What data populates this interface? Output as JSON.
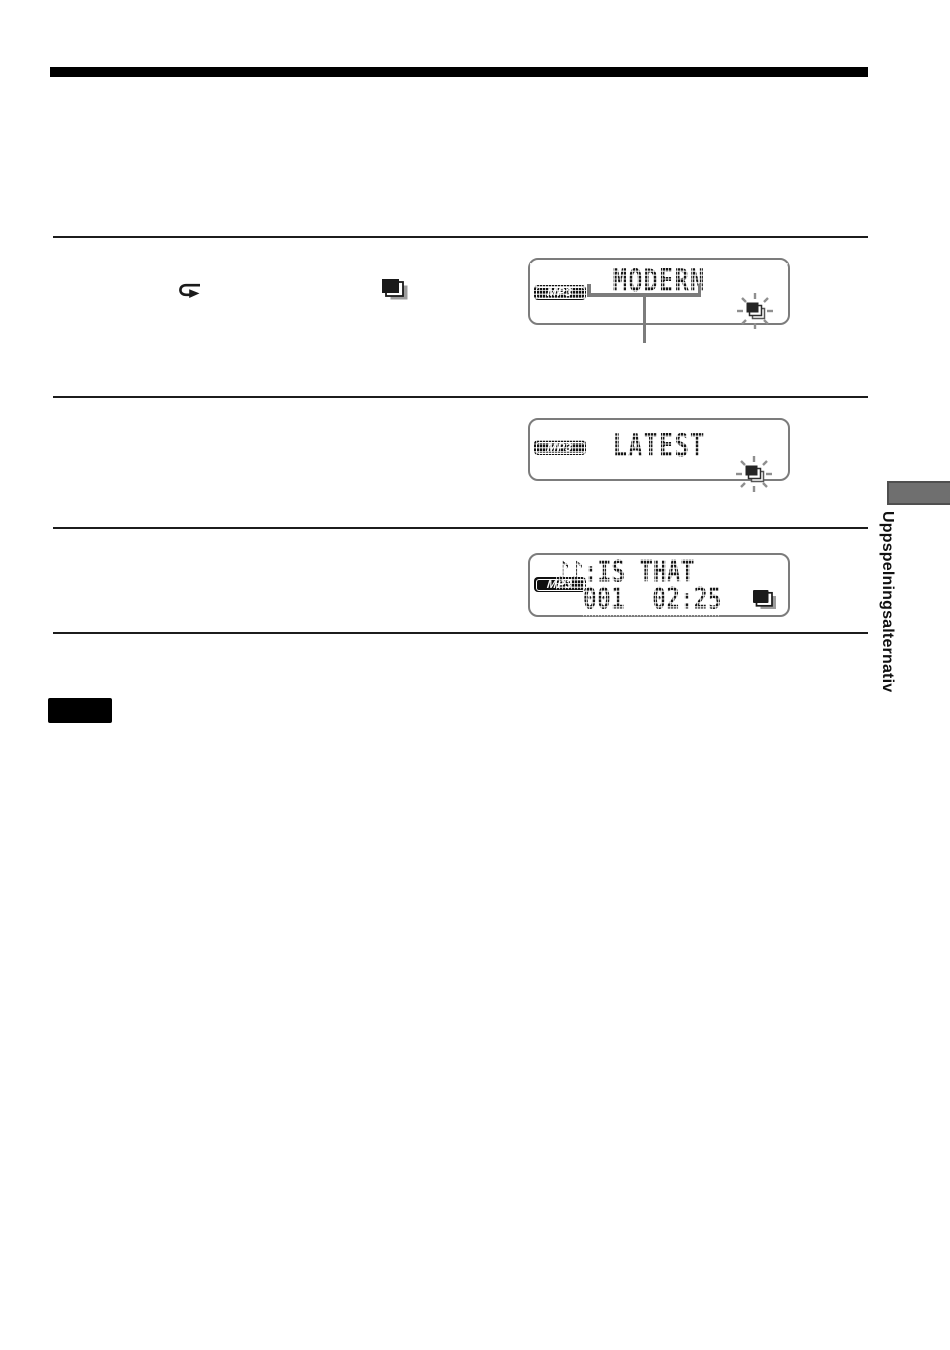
{
  "sidebar": {
    "label": "Uppspelningsalternativ"
  },
  "displays": [
    {
      "badge": "MP3",
      "line1": "MODERN"
    },
    {
      "badge": "MP3",
      "line1": "LATEST"
    },
    {
      "badge": "MP3",
      "line1": "♪♪:IS THAT",
      "line2": "001  02:25"
    }
  ],
  "colors": {
    "lcd_border": "#7c7c7c",
    "rule": "#1c1c1c",
    "tab_fill": "#6f6f6f",
    "badge_bg": "#101010"
  }
}
